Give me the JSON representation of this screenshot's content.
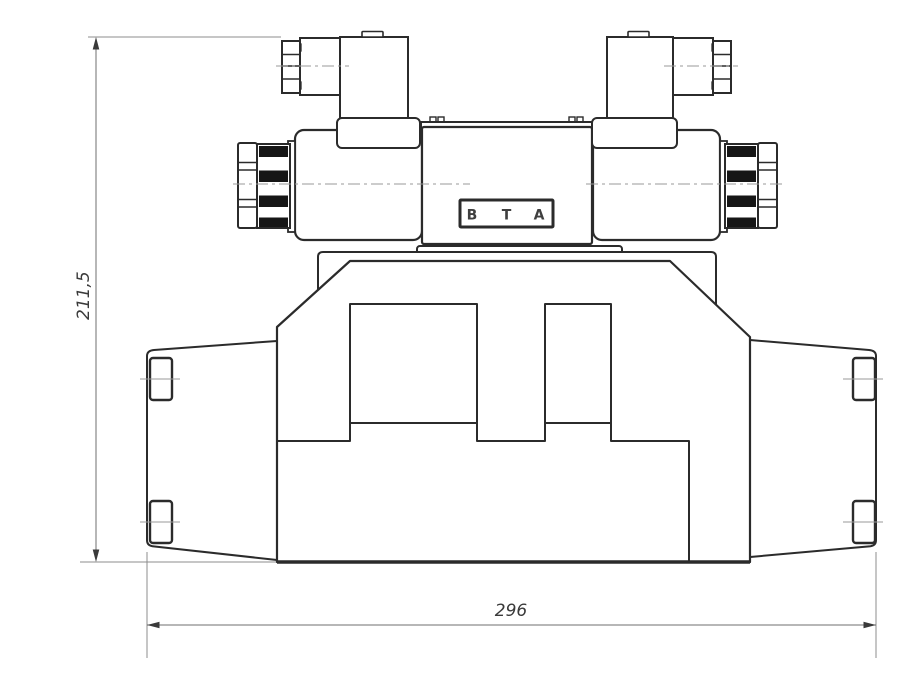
{
  "drawing": {
    "dimensions": {
      "height": "211,5",
      "width": "296"
    },
    "nameplate": {
      "ports": [
        "B",
        "T",
        "A"
      ]
    },
    "colors": {
      "outline": "#2b2b2b",
      "centerline": "#9a9a9a",
      "dimension_line": "#6f6f6f",
      "extension_line": "#8c8c8c",
      "knurl_fill": "#161616",
      "text": "#3a3a3a",
      "background": "#ffffff"
    }
  }
}
